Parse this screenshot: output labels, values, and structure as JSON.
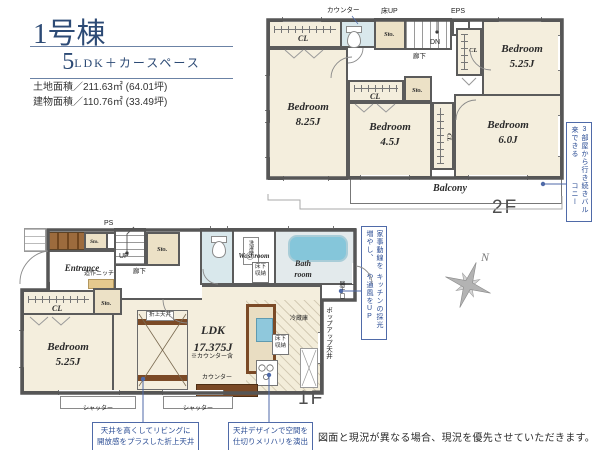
{
  "header": {
    "building": "1号棟",
    "plan_num": "5",
    "plan_rest": "LDK＋カースペース",
    "land_area": "土地面積／211.63㎡ (64.01坪)",
    "building_area": "建物面積／110.76㎡ (33.49坪)"
  },
  "floor2": {
    "label": "2F",
    "counter": "カウンター",
    "floor_up": "床UP",
    "eps": "EPS",
    "dn": "DN",
    "hallway": "廊下",
    "cl_topleft": "CL",
    "sto_top": "Sto.",
    "cl_topright": "CL",
    "cl_mid": "CL",
    "sto_mid": "Sto.",
    "cl_right": "CL",
    "balcony": "Balcony",
    "bedrooms": [
      {
        "name": "Bedroom",
        "size": "8.25J"
      },
      {
        "name": "Bedroom",
        "size": "4.5J"
      },
      {
        "name": "Bedroom",
        "size": "5.25J"
      },
      {
        "name": "Bedroom",
        "size": "6.0J"
      }
    ],
    "annotation": {
      "col1": "3部屋から行き来できる",
      "col2": "続きバルコニー"
    }
  },
  "floor1": {
    "label": "1F",
    "ps": "PS",
    "up": "UP",
    "sto_entry": "Sto.",
    "sto_hall": "Sto.",
    "sto_cl": "Sto.",
    "entrance": "Entrance",
    "niche": "造作ニッチ",
    "hallway": "廊下",
    "washer": "洗濯機",
    "washroom": "Washroom",
    "underfloor_wash": "床下収納",
    "bath_line1": "Bath",
    "bath_line2": "room",
    "backdoor": "勝手口",
    "cl": "CL",
    "bedroom": {
      "name": "Bedroom",
      "size": "5.25J"
    },
    "coffered": "折上天井",
    "ldk_name": "LDK",
    "ldk_size": "17.375J",
    "ldk_note": "※カウンター含",
    "counter": "カウンター",
    "fridge": "冷蔵庫",
    "underfloor_kitchen": "床下収納",
    "popup_ceiling": "ポップアップ天井",
    "shutter_left": "シャッター",
    "shutter_right": "シャッター",
    "annotation": {
      "col1": "家事動線を増やし、",
      "col2": "キッチンの採光や通風をUP"
    }
  },
  "callouts": {
    "coffered_line1": "天井を高くしてリビングに",
    "coffered_line2": "開放感をプラスした折上天井",
    "partition_line1": "天井デザインで空間を",
    "partition_line2": "仕切りメリハリを演出"
  },
  "compass_n": "N",
  "disclaimer": "図面と現況が異なる場合、現況を優先させていただきます。"
}
